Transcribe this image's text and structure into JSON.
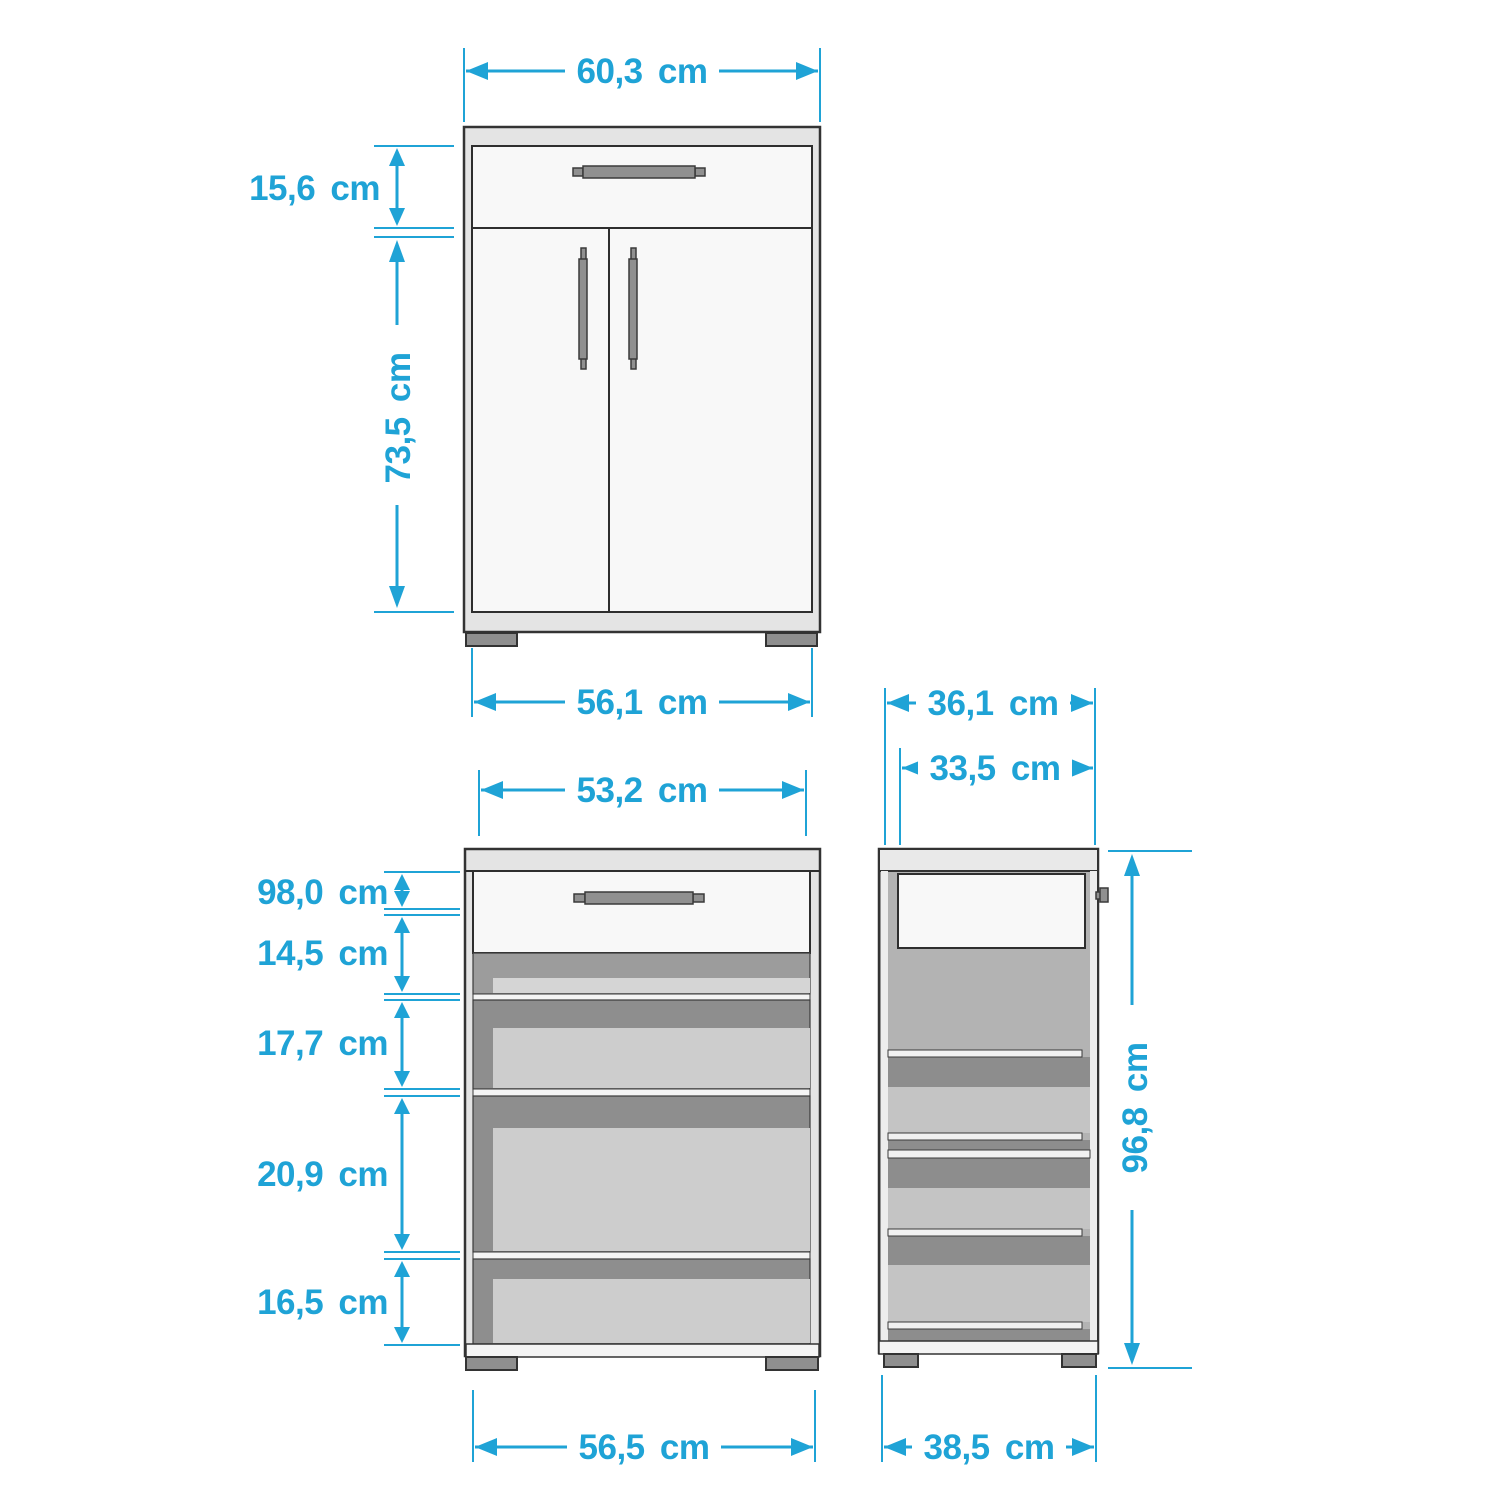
{
  "accent_color": "#1fa3d6",
  "outline_color": "#333333",
  "views": {
    "front": {
      "dim_top_width": "60,3 cm",
      "dim_drawer_height": "15,6 cm",
      "dim_door_height": "73,5 cm",
      "dim_base_width": "56,1 cm"
    },
    "front_open": {
      "dim_top_width": "53,2 cm",
      "dim_section_1": "98,0 cm",
      "dim_section_2": "14,5 cm",
      "dim_section_3": "17,7 cm",
      "dim_section_4": "20,9 cm",
      "dim_section_5": "16,5 cm",
      "dim_base_width": "56,5 cm"
    },
    "side": {
      "dim_top_depth": "36,1 cm",
      "dim_inner_depth": "33,5 cm",
      "dim_height": "96,8 cm",
      "dim_base_depth": "38,5 cm"
    }
  }
}
